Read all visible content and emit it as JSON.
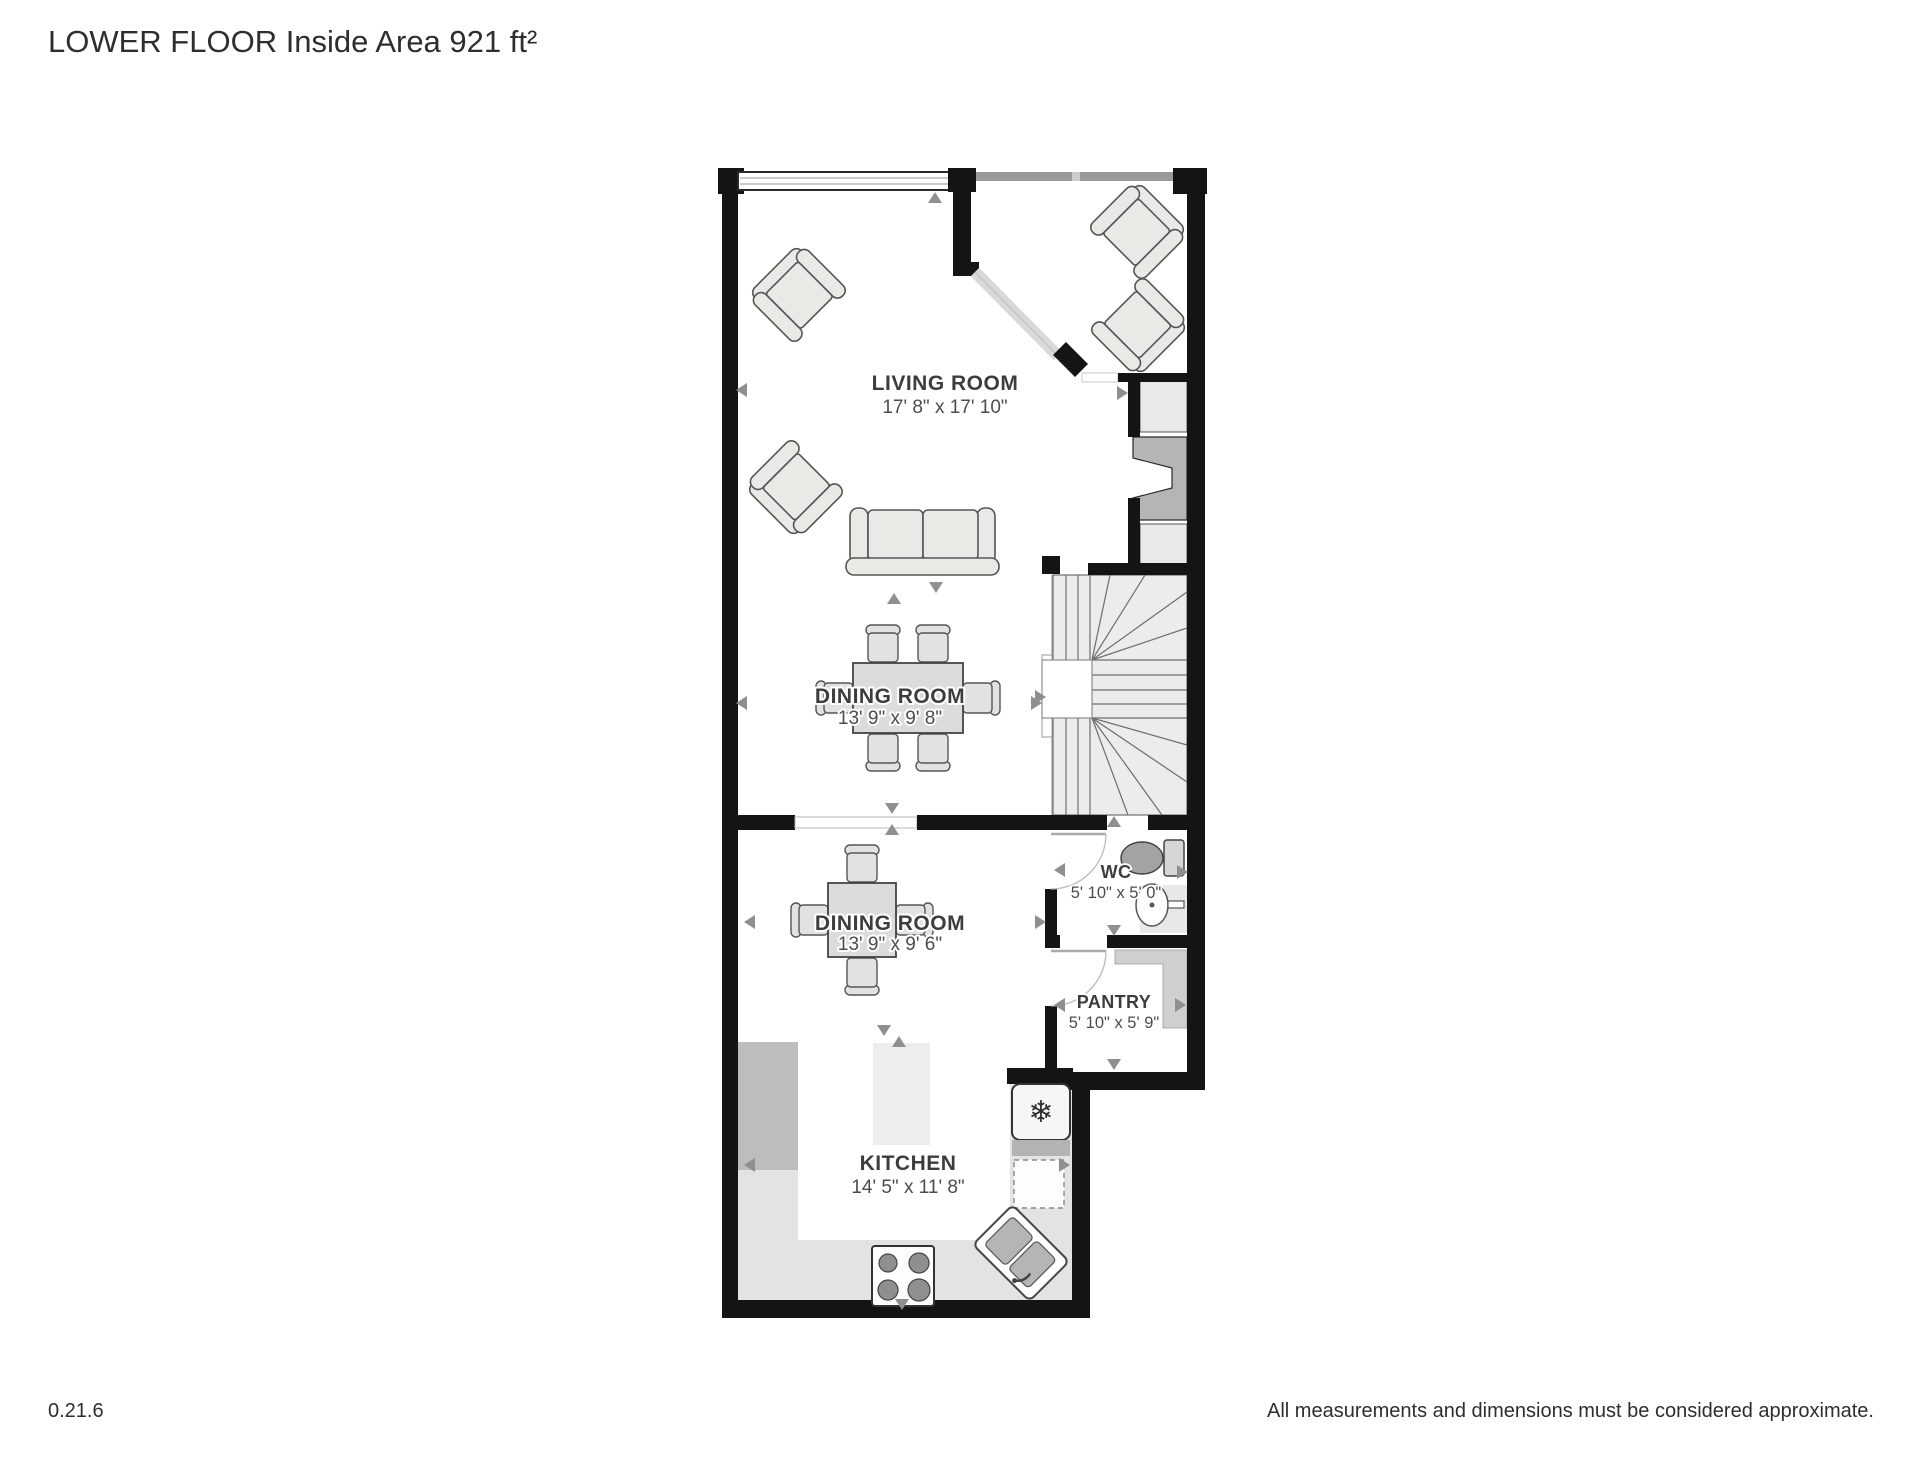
{
  "header": {
    "title": "LOWER FLOOR Inside Area 921 ft²"
  },
  "floor_plan": {
    "rooms": [
      {
        "id": "living-room",
        "name": "LIVING ROOM",
        "dimensions": "17' 8\" x 17' 10\""
      },
      {
        "id": "dining-room-upper",
        "name": "DINING ROOM",
        "dimensions": "13' 9\" x 9' 8\""
      },
      {
        "id": "dining-room-lower",
        "name": "DINING ROOM",
        "dimensions": "13' 9\" x 9' 6\""
      },
      {
        "id": "wc",
        "name": "WC",
        "dimensions": "5' 10\" x 5' 0\""
      },
      {
        "id": "pantry",
        "name": "PANTRY",
        "dimensions": "5' 10\" x 5' 9\""
      },
      {
        "id": "kitchen",
        "name": "KITCHEN",
        "dimensions": "14' 5\" x 11' 8\""
      }
    ],
    "icons": {
      "snowflake": "❄"
    },
    "colors": {
      "wall": "#141414",
      "floor": "#ffffff",
      "furniture_fill": "#ebe9e5",
      "counter_light": "#e3e3e3",
      "counter_dark": "#bdbdbd",
      "stair_fill": "#ececec",
      "arrow": "#8f8f8f"
    }
  },
  "footer": {
    "version": "0.21.6",
    "disclaimer": "All measurements and dimensions must be considered approximate."
  }
}
